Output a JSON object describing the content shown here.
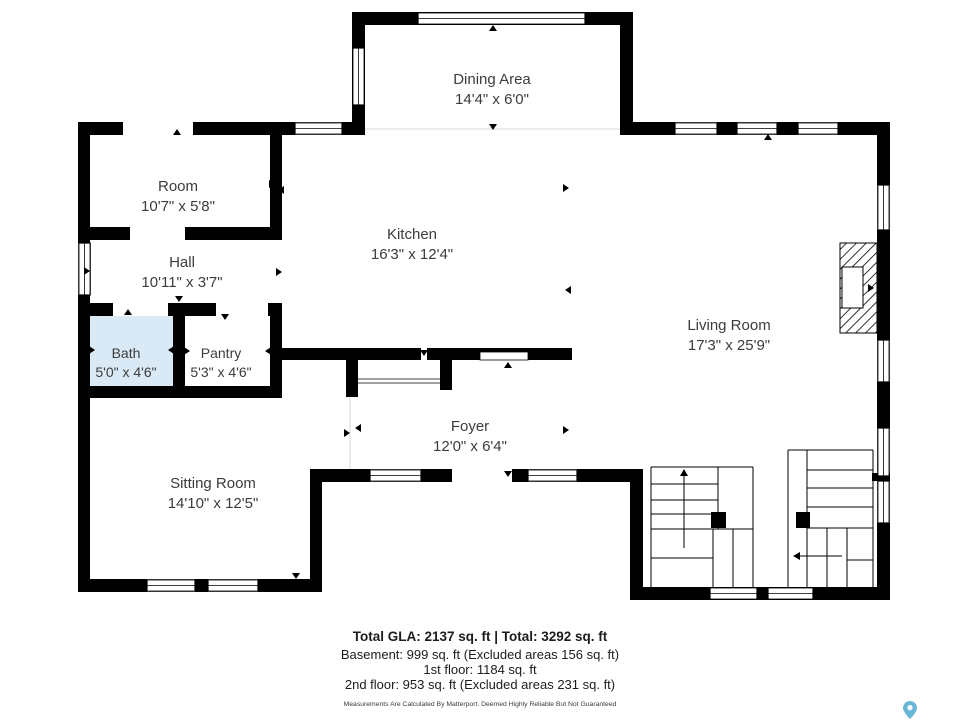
{
  "rooms": [
    {
      "name": "Dining Area",
      "dims": "14'4\" x 6'0\""
    },
    {
      "name": "Room",
      "dims": "10'7\" x 5'8\""
    },
    {
      "name": "Hall",
      "dims": "10'11\" x 3'7\""
    },
    {
      "name": "Kitchen",
      "dims": "16'3\" x 12'4\""
    },
    {
      "name": "Bath",
      "dims": "5'0\" x 4'6\""
    },
    {
      "name": "Pantry",
      "dims": "5'3\" x 4'6\""
    },
    {
      "name": "Living Room",
      "dims": "17'3\" x 25'9\""
    },
    {
      "name": "Foyer",
      "dims": "12'0\" x 6'4\""
    },
    {
      "name": "Sitting Room",
      "dims": "14'10\" x 12'5\""
    }
  ],
  "footer": {
    "total_line": "Total GLA: 2137 sq. ft | Total: 3292 sq. ft",
    "basement_line": "Basement: 999 sq. ft (Excluded areas 156 sq. ft)",
    "first_floor_line": "1st floor: 1184 sq. ft",
    "second_floor_line": "2nd floor: 953 sq. ft (Excluded areas 231 sq. ft)",
    "disclaimer": "Measurements Are Calculated By Matterport. Deemed Highly Reliable But Not Guaranteed"
  },
  "colors": {
    "wall": "#000000",
    "bath_fill": "#d9eaf6",
    "logo_pin": "#68b7d6",
    "label_text": "#3c3c3c"
  }
}
